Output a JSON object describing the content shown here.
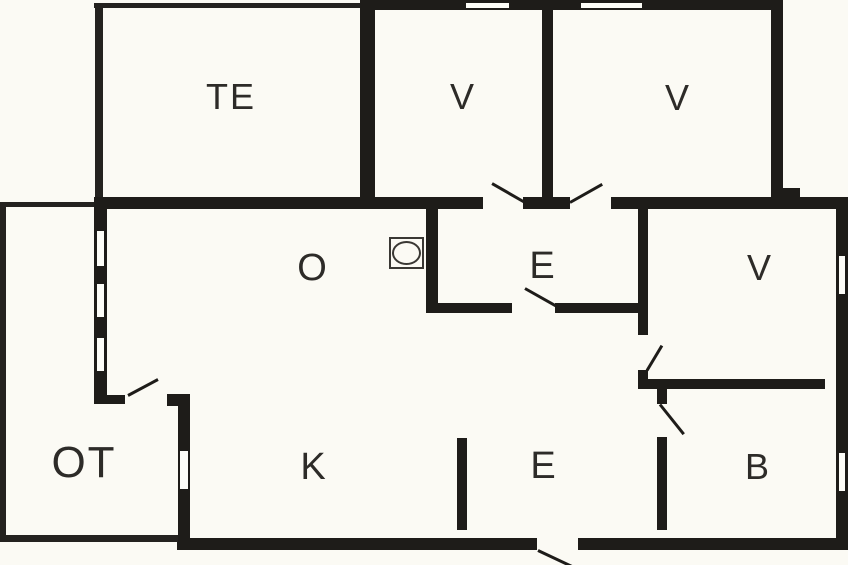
{
  "canvas": {
    "width": 848,
    "height": 565,
    "background": "#fbfaf4",
    "wall_color": "#1e1c19",
    "thin_wall_color": "#24221f",
    "label_color": "#2d2b28",
    "window_fill": "#fdfdf8",
    "fixture_outline": "#3a3834"
  },
  "rooms": [
    {
      "id": "te",
      "label": "TE",
      "cx": 231,
      "cy": 97,
      "size": 36
    },
    {
      "id": "v1",
      "label": "V",
      "cx": 463,
      "cy": 97,
      "size": 36
    },
    {
      "id": "v2",
      "label": "V",
      "cx": 678,
      "cy": 98,
      "size": 36
    },
    {
      "id": "o",
      "label": "O",
      "cx": 313,
      "cy": 268,
      "size": 38
    },
    {
      "id": "e1",
      "label": "E",
      "cx": 543,
      "cy": 266,
      "size": 38
    },
    {
      "id": "v3",
      "label": "V",
      "cx": 760,
      "cy": 268,
      "size": 36
    },
    {
      "id": "ot",
      "label": "OT",
      "cx": 84,
      "cy": 463,
      "size": 44
    },
    {
      "id": "k",
      "label": "K",
      "cx": 314,
      "cy": 467,
      "size": 38
    },
    {
      "id": "e2",
      "label": "E",
      "cx": 544,
      "cy": 466,
      "size": 38
    },
    {
      "id": "b",
      "label": "B",
      "cx": 758,
      "cy": 467,
      "size": 36
    }
  ],
  "walls": {
    "thick": [
      {
        "id": "top-v-block",
        "rect": [
          360,
          0,
          423,
          10
        ]
      },
      {
        "id": "te-v1-divider",
        "rect": [
          360,
          0,
          15,
          209
        ]
      },
      {
        "id": "v1-v2-divider",
        "rect": [
          542,
          0,
          11,
          199
        ]
      },
      {
        "id": "v2-right",
        "rect": [
          771,
          0,
          12,
          209
        ]
      },
      {
        "id": "corner-bump",
        "rect": [
          783,
          188,
          17,
          21
        ]
      },
      {
        "id": "main-band-a",
        "rect": [
          94,
          197,
          389,
          12
        ]
      },
      {
        "id": "main-band-b",
        "rect": [
          523,
          197,
          47,
          12
        ]
      },
      {
        "id": "main-band-c",
        "rect": [
          611,
          197,
          237,
          12
        ]
      },
      {
        "id": "left-exterior",
        "rect": [
          94,
          197,
          13,
          206
        ]
      },
      {
        "id": "left-bottom-stub",
        "rect": [
          94,
          395,
          31,
          9
        ]
      },
      {
        "id": "otk-corner",
        "rect": [
          167,
          394,
          23,
          12
        ]
      },
      {
        "id": "ot-k-wall",
        "rect": [
          178,
          394,
          12,
          156
        ]
      },
      {
        "id": "bottom-a",
        "rect": [
          177,
          538,
          360,
          12
        ]
      },
      {
        "id": "bottom-b",
        "rect": [
          578,
          538,
          270,
          12
        ]
      },
      {
        "id": "right-exterior",
        "rect": [
          836,
          197,
          12,
          353
        ]
      },
      {
        "id": "e1-left",
        "rect": [
          426,
          209,
          12,
          104
        ]
      },
      {
        "id": "e1-bottom-a",
        "rect": [
          426,
          303,
          86,
          10
        ]
      },
      {
        "id": "e1-bottom-b",
        "rect": [
          555,
          303,
          93,
          10
        ]
      },
      {
        "id": "e1-v3-wall",
        "rect": [
          638,
          209,
          10,
          126
        ]
      },
      {
        "id": "e1-v3-corner",
        "rect": [
          638,
          370,
          10,
          19
        ]
      },
      {
        "id": "v3-b-wall",
        "rect": [
          638,
          379,
          187,
          10
        ]
      },
      {
        "id": "b-stub-top",
        "rect": [
          657,
          389,
          10,
          15
        ]
      },
      {
        "id": "b-stub",
        "rect": [
          657,
          437,
          10,
          93
        ]
      },
      {
        "id": "k-e2-stub",
        "rect": [
          457,
          438,
          10,
          92
        ]
      }
    ],
    "thin": [
      {
        "id": "te-top",
        "rect": [
          94,
          3,
          266,
          5
        ]
      },
      {
        "id": "te-left",
        "rect": [
          95,
          3,
          8,
          194
        ]
      },
      {
        "id": "ot-top",
        "rect": [
          0,
          202,
          94,
          5
        ]
      },
      {
        "id": "ot-left",
        "rect": [
          0,
          202,
          6,
          340
        ]
      },
      {
        "id": "ot-bottom",
        "rect": [
          0,
          535,
          178,
          7
        ]
      }
    ]
  },
  "windows": [
    {
      "id": "w-top-v1",
      "rect": [
        465,
        2,
        45,
        7
      ]
    },
    {
      "id": "w-top-v2",
      "rect": [
        580,
        2,
        63,
        7
      ]
    },
    {
      "id": "w-left-1",
      "rect": [
        96,
        230,
        9,
        37
      ]
    },
    {
      "id": "w-left-2",
      "rect": [
        96,
        283,
        9,
        35
      ]
    },
    {
      "id": "w-left-3",
      "rect": [
        96,
        337,
        9,
        35
      ]
    },
    {
      "id": "w-otk",
      "rect": [
        179,
        450,
        10,
        40
      ]
    },
    {
      "id": "w-right-v3",
      "rect": [
        838,
        255,
        8,
        40
      ]
    },
    {
      "id": "w-right-b",
      "rect": [
        838,
        452,
        8,
        40
      ]
    }
  ],
  "door_swings": [
    {
      "id": "door-swing-v1",
      "line": [
        525,
        202,
        492,
        183
      ]
    },
    {
      "id": "door-swing-v2",
      "line": [
        570,
        202,
        602,
        184
      ]
    },
    {
      "id": "door-swing-e1",
      "line": [
        525,
        288,
        557,
        306
      ]
    },
    {
      "id": "door-swing-v3",
      "line": [
        647,
        370,
        662,
        345
      ]
    },
    {
      "id": "door-swing-b",
      "line": [
        660,
        404,
        684,
        434
      ]
    },
    {
      "id": "door-swing-entry",
      "line": [
        538,
        550,
        572,
        566
      ]
    },
    {
      "id": "door-swing-ot",
      "line": [
        128,
        395,
        158,
        379
      ]
    }
  ],
  "fixtures": [
    {
      "id": "stove-symbol",
      "type": "square-ellipse",
      "rect": [
        389,
        237,
        35,
        32
      ]
    }
  ]
}
